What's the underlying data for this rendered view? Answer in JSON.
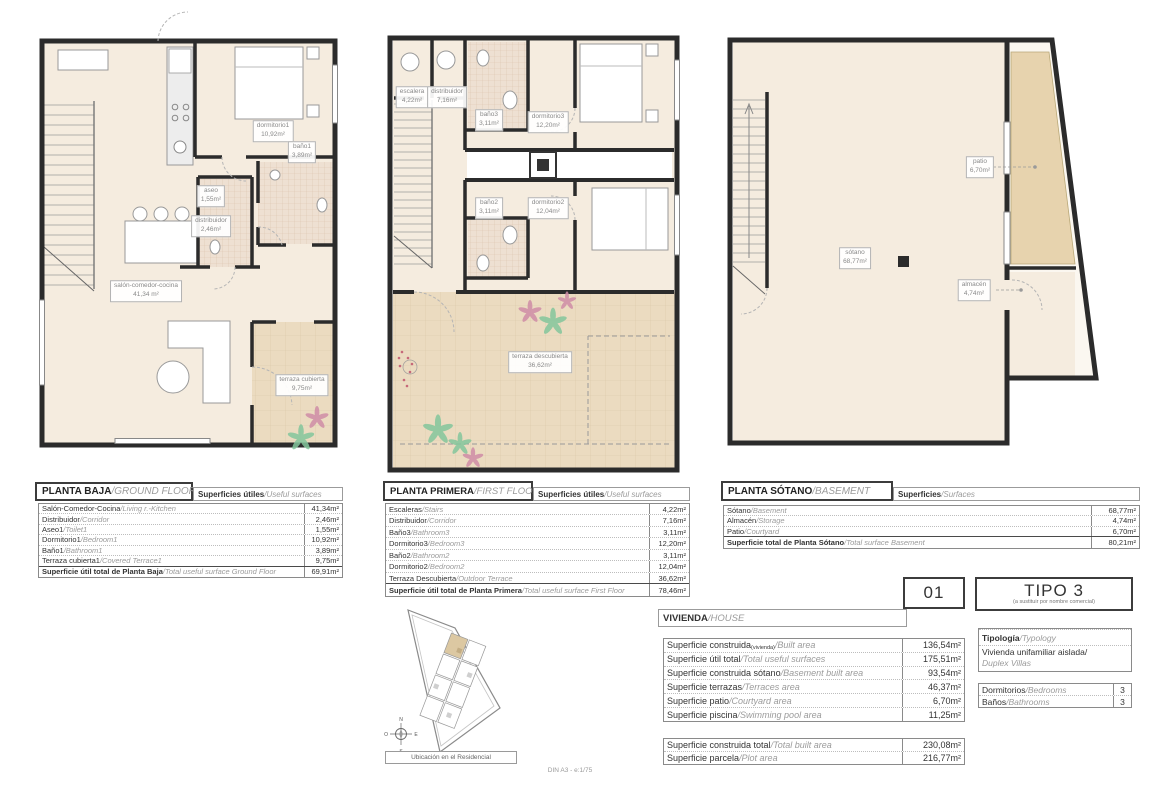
{
  "colors": {
    "wall": "#2b2b2b",
    "floor": "#f5ecdf",
    "terrace": "#ebdbc0",
    "patio": "#e7d3ae",
    "tile": "#eee0d2",
    "site_highlight": "#dcc8a2",
    "plant_green": "#84c69c",
    "plant_pink": "#cf8da7"
  },
  "plans": {
    "ground": {
      "rooms": {
        "salon": {
          "name": "salón-comedor-cocina",
          "area": "41,34 m²"
        },
        "dormitorio1": {
          "name": "dormitorio1",
          "area": "10,92m²"
        },
        "bano1": {
          "name": "baño1",
          "area": "3,89m²"
        },
        "aseo": {
          "name": "aseo",
          "area": "1,55m²"
        },
        "distribuidor": {
          "name": "distribuidor",
          "area": "2,46m²"
        },
        "terraza": {
          "name": "terraza cubierta",
          "area": "9,75m²"
        }
      }
    },
    "first": {
      "rooms": {
        "escalera": {
          "name": "escalera",
          "area": "4,22m²"
        },
        "distribuidor": {
          "name": "distribuidor",
          "area": "7,16m²"
        },
        "bano3": {
          "name": "baño3",
          "area": "3,11m²"
        },
        "dormitorio3": {
          "name": "dormitorio3",
          "area": "12,20m²"
        },
        "bano2": {
          "name": "baño2",
          "area": "3,11m²"
        },
        "dormitorio2": {
          "name": "dormitorio2",
          "area": "12,04m²"
        },
        "terraza": {
          "name": "terraza descubierta",
          "area": "36,62m²"
        }
      }
    },
    "basement": {
      "rooms": {
        "sotano": {
          "name": "sótano",
          "area": "68,77m²"
        },
        "patio": {
          "name": "patio",
          "area": "6,70m²"
        },
        "almacen": {
          "name": "almacén",
          "area": "4,74m²"
        }
      }
    }
  },
  "tables": {
    "ground": {
      "title": "PLANTA BAJA",
      "title_en": "/GROUND FLOOR",
      "header": "Superficies útiles",
      "header_en": "/Useful surfaces",
      "rows": [
        {
          "es": "Salón-Comedor-Cocina",
          "en": "/Living r.-Kitchen",
          "value": "41,34m²"
        },
        {
          "es": "Distribuidor",
          "en": "/Corridor",
          "value": "2,46m²"
        },
        {
          "es": "Aseo1",
          "en": "/Toilet1",
          "value": "1,55m²"
        },
        {
          "es": "Dormitorio1",
          "en": "/Bedroom1",
          "value": "10,92m²"
        },
        {
          "es": "Baño1",
          "en": "/Bathroom1",
          "value": "3,89m²"
        },
        {
          "es": "Terraza cubierta1",
          "en": "/Covered Terrace1",
          "value": "9,75m²"
        }
      ],
      "total": {
        "es": "Superficie útil total de Planta Baja",
        "en": "/Total useful surface Ground Floor",
        "value": "69,91m²"
      }
    },
    "first": {
      "title": "PLANTA PRIMERA",
      "title_en": "/FIRST FLOOR",
      "header": "Superficies útiles",
      "header_en": "/Useful surfaces",
      "rows": [
        {
          "es": "Escaleras",
          "en": "/Stairs",
          "value": "4,22m²"
        },
        {
          "es": "Distribuidor",
          "en": "/Corridor",
          "value": "7,16m²"
        },
        {
          "es": "Baño3",
          "en": "/Bathroom3",
          "value": "3,11m²"
        },
        {
          "es": "Dormitorio3",
          "en": "/Bedroom3",
          "value": "12,20m²"
        },
        {
          "es": "Baño2",
          "en": "/Bathroom2",
          "value": "3,11m²"
        },
        {
          "es": "Dormitorio2",
          "en": "/Bedroom2",
          "value": "12,04m²"
        },
        {
          "es": "Terraza Descubierta",
          "en": "/Outdoor Terrace",
          "value": "36,62m²"
        }
      ],
      "total": {
        "es": "Superficie útil total de Planta Primera",
        "en": "/Total useful surface First Floor",
        "value": "78,46m²"
      }
    },
    "basement": {
      "title": "PLANTA SÓTANO",
      "title_en": "/BASEMENT",
      "header": "Superficies",
      "header_en": "/Surfaces",
      "rows": [
        {
          "es": "Sótano",
          "en": "/Basement",
          "value": "68,77m²"
        },
        {
          "es": "Almacén",
          "en": "/Storage",
          "value": "4,74m²"
        },
        {
          "es": "Patio",
          "en": "/Courtyard",
          "value": "6,70m²"
        }
      ],
      "total": {
        "es": "Superficie total de Planta Sótano",
        "en": "/Total surface Basement",
        "value": "80,21m²"
      }
    },
    "vivienda": {
      "title": "VIVIENDA",
      "title_en": "/HOUSE",
      "rows": [
        {
          "es": "Superficie construida",
          "sub": "(vivienda)",
          "en": "/Built area",
          "value": "136,54m²"
        },
        {
          "es": "Superficie útil total",
          "en": "/Total useful surfaces",
          "value": "175,51m²"
        },
        {
          "es": "Superficie construida sótano",
          "en": "/Basement built area",
          "value": "93,54m²"
        },
        {
          "es": "Superficie terrazas",
          "en": "/Terraces area",
          "value": "46,37m²"
        },
        {
          "es": "Superficie patio",
          "en": "/Courtyard area",
          "value": "6,70m²"
        },
        {
          "es": "Superficie piscina",
          "en": "/Swimming pool area",
          "value": "11,25m²"
        }
      ]
    },
    "totals": {
      "rows": [
        {
          "es": "Superficie construida total",
          "en": "/Total built area",
          "value": "230,08m²"
        },
        {
          "es": "Superficie parcela",
          "en": "/Plot area",
          "value": "216,77m²"
        }
      ]
    }
  },
  "tipo": {
    "unit": "01",
    "name": "TIPO 3",
    "note": "(a sustituir por nombre comercial)",
    "typology_label": "Tipología",
    "typology_label_en": "/Typology",
    "typology_value": "Vivienda unifamiliar aislada/",
    "typology_value_en": "Duplex Villas",
    "rooms": [
      {
        "es": "Dormitorios",
        "en": "/Bedrooms",
        "value": "3"
      },
      {
        "es": "Baños",
        "en": "/Bathrooms",
        "value": "3"
      }
    ]
  },
  "site": {
    "caption": "Ubicación en el Residencial",
    "compass": {
      "n": "N",
      "s": "S",
      "e": "E",
      "o": "O"
    }
  },
  "footer": "DIN A3 - e:1/75"
}
